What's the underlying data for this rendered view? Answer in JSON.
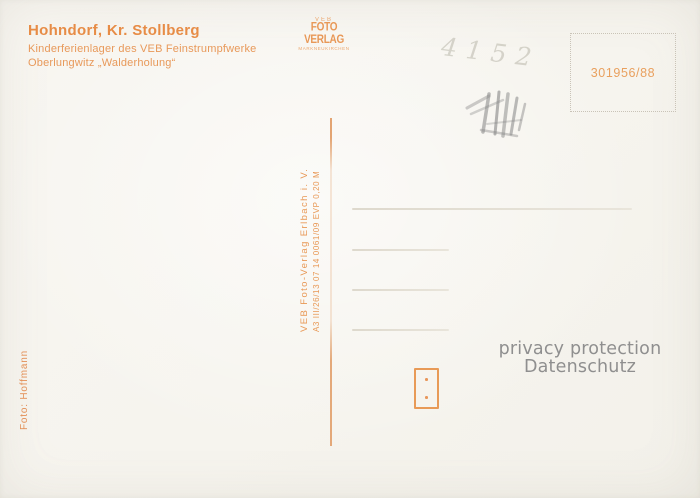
{
  "postcard": {
    "caption": {
      "title": "Hohndorf, Kr. Stollberg",
      "subtitle1": "Kinderferienlager des VEB Feinstrumpfwerke",
      "subtitle2": "Oberlungwitz „Walderholung“"
    },
    "publisher_logo": {
      "top_text": "VEB",
      "name": "FOTO VERLAG",
      "sub_text": "MARKNEUKIRCHEN"
    },
    "stamp_box": {
      "number": "301956/88"
    },
    "imprint": {
      "publisher_line": "VEB Foto-Verlag Erlbach i. V.",
      "print_code_line": "A3 III/26/13 07 14 0061/09 EVP 0,20 M"
    },
    "photo_credit": "Foto: Hoffmann",
    "pencil_note": "4152",
    "watermark": {
      "line1": "privacy protection",
      "line2": "Datenschutz"
    },
    "colors": {
      "accent_orange": "#e8944f",
      "paper": "#f7f5ef",
      "watermark_gray": "#8f8f8f",
      "address_line_gray": "#e3dfd4"
    },
    "address_line_count": 4
  }
}
